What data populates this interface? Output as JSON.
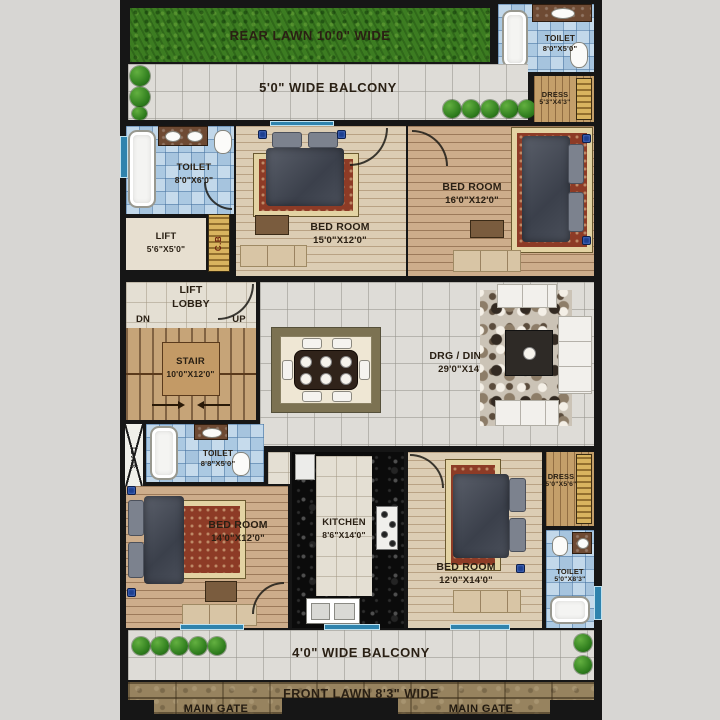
{
  "plan": {
    "rear_lawn": {
      "label": "REAR LAWN 10'0\" WIDE"
    },
    "balcony_top": {
      "label": "5'0\" WIDE BALCONY"
    },
    "toilet_top_right": {
      "name": "TOILET",
      "size": "8'0\"X5'0\""
    },
    "dress_top_right": {
      "name": "DRESS",
      "size": "5'3\"X4'3\""
    },
    "toilet_left": {
      "name": "TOILET",
      "size": "8'0\"X6'0\""
    },
    "lift": {
      "name": "LIFT",
      "size": "5'6\"X5'0\""
    },
    "cupboard": {
      "label": "C.B"
    },
    "bedroom_15": {
      "name": "BED ROOM",
      "size": "15'0\"X12'0\""
    },
    "bedroom_16": {
      "name": "BED ROOM",
      "size": "16'0\"X12'0\""
    },
    "lift_lobby": {
      "line1": "LIFT",
      "line2": "LOBBY",
      "dn": "DN",
      "up": "UP"
    },
    "stair": {
      "name": "STAIR",
      "size": "10'0\"X12'0\""
    },
    "drg_dining": {
      "name": "DRG / DINING",
      "size": "29'0\"X14'6\""
    },
    "shaft": {
      "label": "SHAFT"
    },
    "toilet_mid": {
      "name": "TOILET",
      "size": "8'8\"X5'0\""
    },
    "bedroom_14": {
      "name": "BED ROOM",
      "size": "14'0\"X12'0\""
    },
    "kitchen": {
      "name": "KITCHEN",
      "size": "8'6\"X14'0\""
    },
    "bedroom_12": {
      "name": "BED ROOM",
      "size": "12'0\"X14'0\""
    },
    "dress_bottom_right": {
      "name": "DRESS",
      "size": "5'0\"X5'6\""
    },
    "toilet_bottom_right": {
      "name": "TOILET",
      "size": "5'0\"X8'3\""
    },
    "balcony_bottom": {
      "label": "4'0\" WIDE BALCONY"
    },
    "front_lawn": {
      "label": "FRONT LAWN 8'3\" WIDE"
    },
    "main_gate_left": {
      "label": "MAIN GATE"
    },
    "main_gate_right": {
      "label": "MAIN GATE"
    }
  },
  "colors": {
    "wall": "#161616",
    "grass": "#3c7c21",
    "floor_tile": "#dedcd7",
    "bath_tile": "#bcd4e8",
    "wood_light": "#dccdb4",
    "wood_dark": "#cdad8b",
    "paving": "#97835f",
    "label_text": "#2a2014",
    "window_accent": "#2f83ad"
  }
}
